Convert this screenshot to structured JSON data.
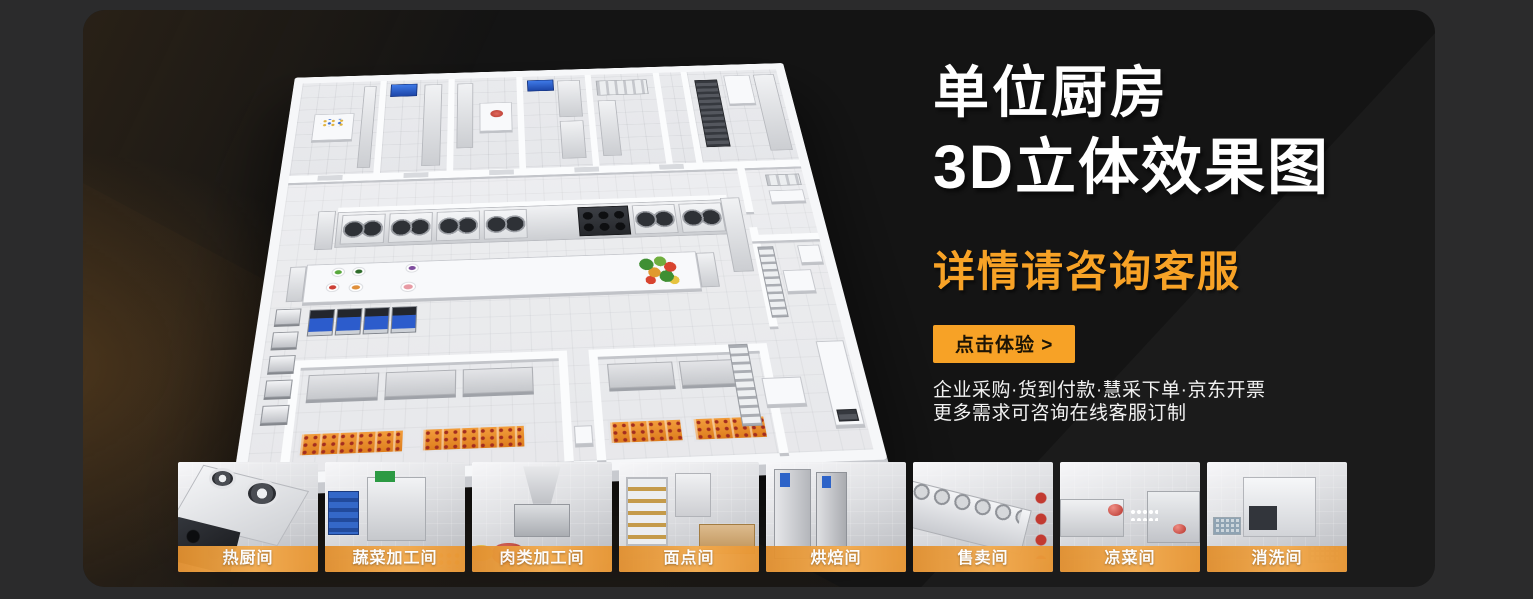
{
  "hero": {
    "title_line1": "单位厨房",
    "title_line2": "3D立体效果图",
    "subtitle": "详情请咨询客服",
    "cta_label": "点击体验 >",
    "note_line1": "企业采购·货到付款·慧采下单·京东开票",
    "note_line2": "更多需求可咨询在线客服订制"
  },
  "thumbnails": [
    {
      "label": "热厨间"
    },
    {
      "label": "蔬菜加工间"
    },
    {
      "label": "肉类加工间"
    },
    {
      "label": "面点间"
    },
    {
      "label": "烘焙间"
    },
    {
      "label": "售卖间"
    },
    {
      "label": "凉菜间"
    },
    {
      "label": "消洗间"
    }
  ],
  "colors": {
    "page_bg": "#2B2B2C",
    "card_bg": "#141414",
    "accent_orange": "#F7A226",
    "thumb_label_bar": "#ED9C3C",
    "cta_text": "#1C1405",
    "title_text": "#FFFFFF",
    "note_text": "#F2F2F2"
  }
}
